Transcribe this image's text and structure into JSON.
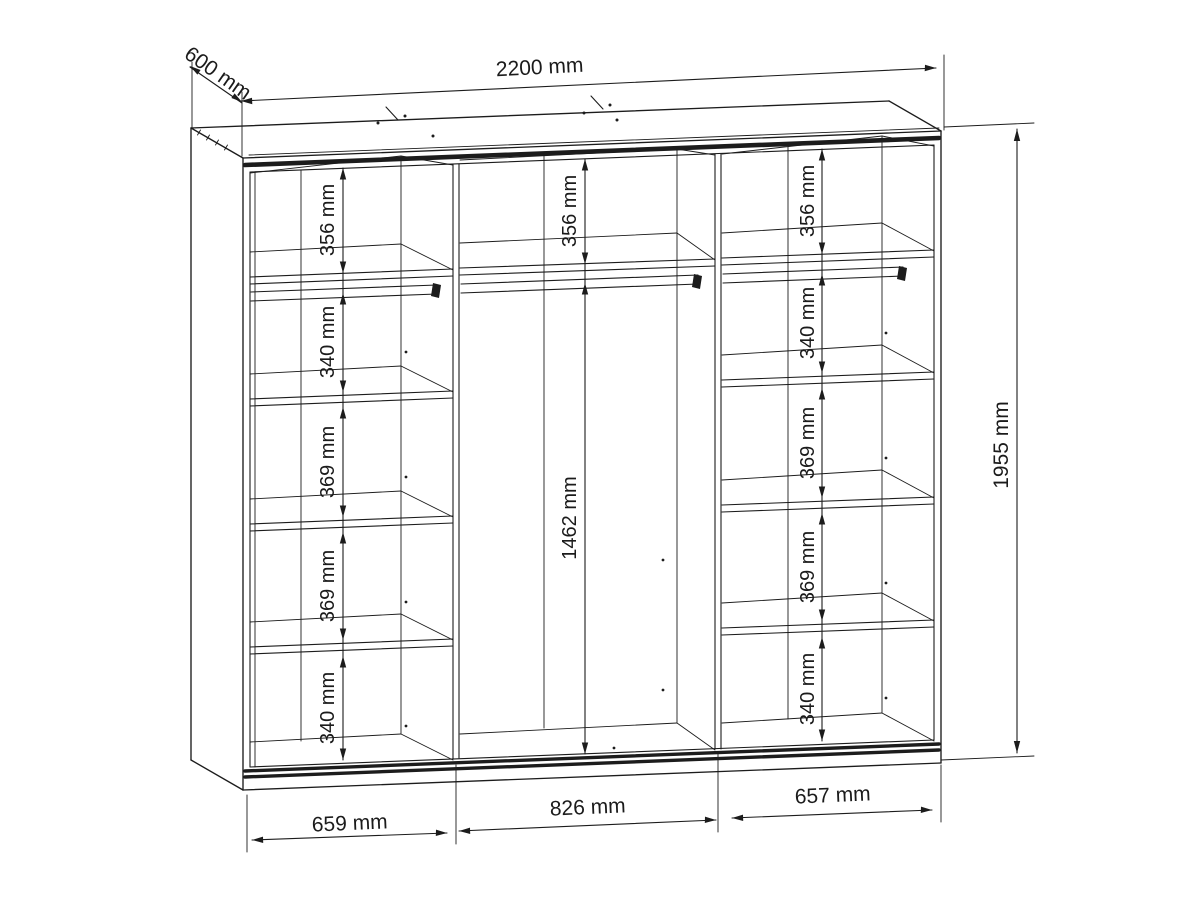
{
  "diagram": {
    "title": "wardrobe-interior-dimension-drawing",
    "ink_color": "#1c1c1c",
    "width_label": "2200 mm",
    "depth_label": "600 mm",
    "height_label": "1955 mm",
    "left_section_dims": [
      "356 mm",
      "340 mm",
      "369 mm",
      "369 mm",
      "340 mm"
    ],
    "middle_section_dims": [
      "356 mm",
      "1462 mm"
    ],
    "right_section_dims": [
      "356 mm",
      "340 mm",
      "369 mm",
      "369 mm",
      "340 mm"
    ],
    "section_widths": [
      "659 mm",
      "826 mm",
      "657 mm"
    ]
  }
}
